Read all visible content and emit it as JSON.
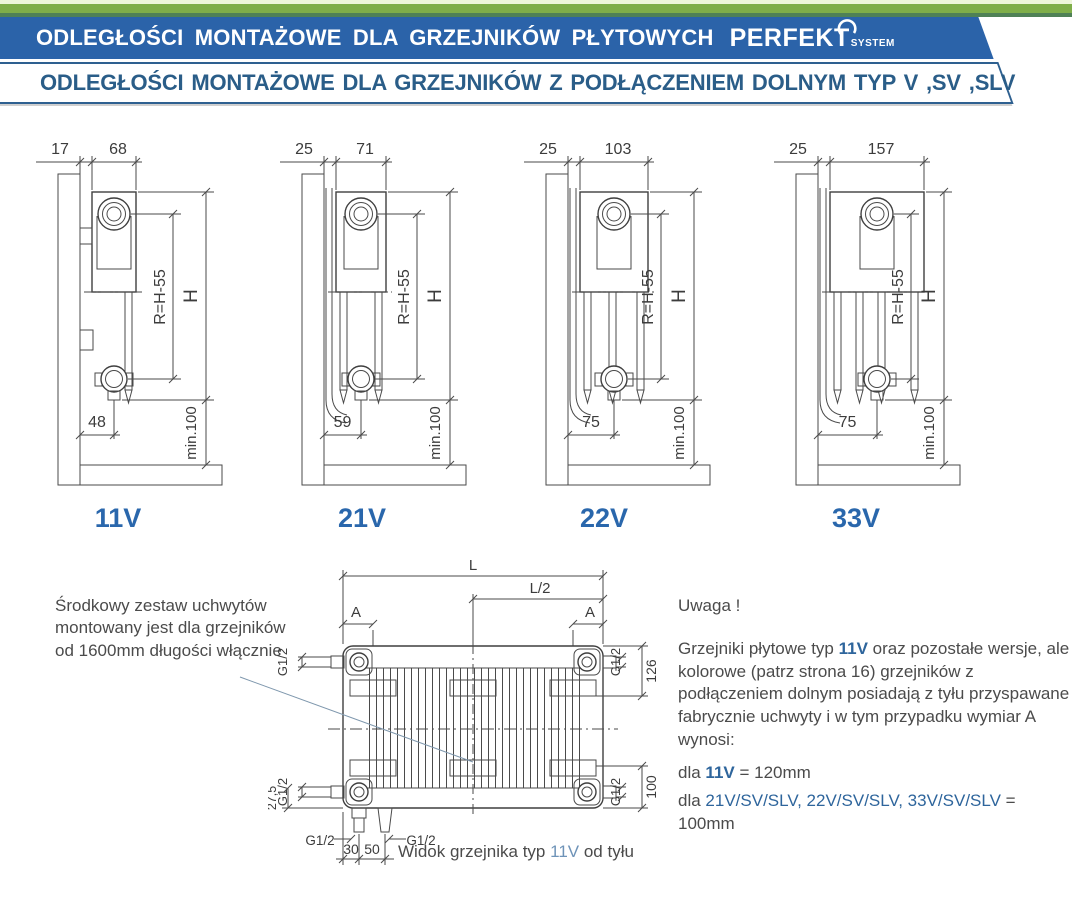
{
  "header": {
    "title": "ODLEGŁOŚCI  MONTAŻOWE  DLA GRZEJNIKÓW  PŁYTOWYCH",
    "brand": "PERFEKT",
    "brand_sub": "SYSTEM",
    "subtitle": "ODLEGŁOŚCI MONTAŻOWE DLA GRZEJNIKÓW Z PODŁĄCZENIEM DOLNYM TYP V ,SV ,SLV"
  },
  "colors": {
    "banner_blue": "#2b63a9",
    "heading_blue": "#2a5d88",
    "type_label_blue": "#2a67ac",
    "accent_green": "#7fae49",
    "drawing_gray": "#4a4a4a"
  },
  "diagrams": [
    {
      "label": "11V",
      "wall_offset": "17",
      "depth": "68",
      "r_label": "R=H-55",
      "h_label": "H",
      "pipe_offset": "48",
      "floor_label": "min.100"
    },
    {
      "label": "21V",
      "wall_offset": "25",
      "depth": "71",
      "r_label": "R=H-55",
      "h_label": "H",
      "pipe_offset": "59",
      "floor_label": "min.100"
    },
    {
      "label": "22V",
      "wall_offset": "25",
      "depth": "103",
      "r_label": "R=H-55",
      "h_label": "H",
      "pipe_offset": "75",
      "floor_label": "min.100"
    },
    {
      "label": "33V",
      "wall_offset": "25",
      "depth": "157",
      "r_label": "R=H-55",
      "h_label": "H",
      "pipe_offset": "75",
      "floor_label": "min.100"
    }
  ],
  "note_left": {
    "line1": "Środkowy zestaw uchwytów",
    "line2": "montowany jest dla grzejników",
    "line3": "od 1600mm długości włącznie"
  },
  "rear": {
    "l": "L",
    "l_half": "L/2",
    "a": "A",
    "g12": "G1/2",
    "d126": "126",
    "d100": "100",
    "d275": "27,5",
    "d30": "30",
    "d50": "50"
  },
  "caption": {
    "pre": "Widok grzejnika typ ",
    "type": "11V",
    "post": " od tyłu"
  },
  "note_right": {
    "heading": "Uwaga !",
    "p1a": "Grzejniki płytowe typ ",
    "p1b": "11V",
    "p1c": " oraz pozostałe wersje, ale kolorowe (patrz strona 16) grzejników z podłączeniem dolnym posiadają z tyłu przyspawane fabrycznie uchwyty i w tym przypadku wymiar A wynosi:",
    "r1a": "dla ",
    "r1b": "11V",
    "r1c": " = 120mm",
    "r2a": "dla ",
    "r2b": "21V/SV/SLV, 22V/SV/SLV, 33V/SV/SLV",
    "r2c": " = 100mm"
  }
}
